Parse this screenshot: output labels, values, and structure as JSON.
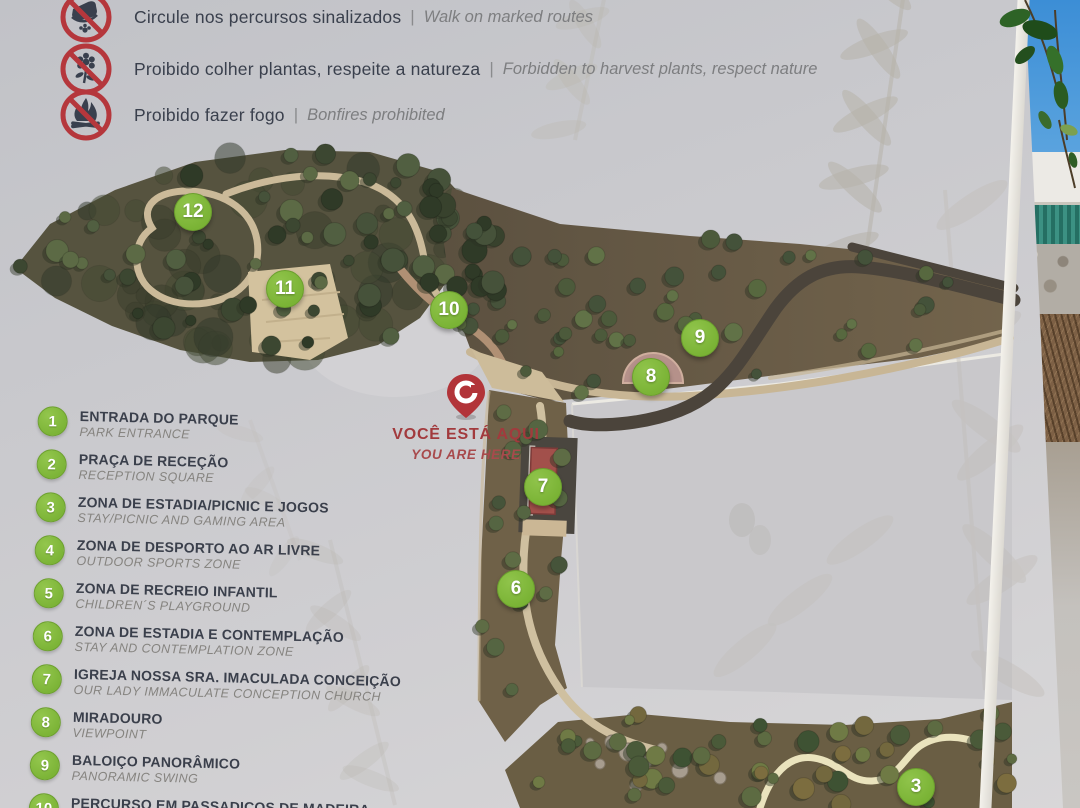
{
  "sign": {
    "rules": {
      "divider": "|",
      "items": [
        {
          "icon": "no-walking-off-trail-icon",
          "pt": "Circule nos percursos sinalizados",
          "en": "Walk on marked routes"
        },
        {
          "icon": "no-picking-plants-icon",
          "pt": "Proibido colher plantas, respeite a natureza",
          "en": "Forbidden to harvest plants, respect nature"
        },
        {
          "icon": "no-bonfires-icon",
          "pt": "Proibido fazer fogo",
          "en": "Bonfires prohibited"
        }
      ]
    },
    "you_are_here": {
      "pt": "VOCÊ ESTÁ AQUI",
      "en": "YOU ARE HERE"
    },
    "legend": {
      "items": [
        {
          "num": "1",
          "pt": "ENTRADA DO PARQUE",
          "en": "PARK ENTRANCE"
        },
        {
          "num": "2",
          "pt": "PRAÇA DE RECEÇÃO",
          "en": "RECEPTION SQUARE"
        },
        {
          "num": "3",
          "pt": "ZONA DE ESTADIA/PICNIC E JOGOS",
          "en": "STAY/PICNIC AND GAMING AREA"
        },
        {
          "num": "4",
          "pt": "ZONA DE DESPORTO AO AR LIVRE",
          "en": "OUTDOOR SPORTS ZONE"
        },
        {
          "num": "5",
          "pt": "ZONA DE RECREIO INFANTIL",
          "en": "CHILDREN´S PLAYGROUND"
        },
        {
          "num": "6",
          "pt": "ZONA DE ESTADIA E CONTEMPLAÇÃO",
          "en": "STAY AND CONTEMPLATION ZONE"
        },
        {
          "num": "7",
          "pt": "IGREJA NOSSA SRA. IMACULADA CONCEIÇÃO",
          "en": "OUR LADY IMMACULATE CONCEPTION CHURCH"
        },
        {
          "num": "8",
          "pt": "MIRADOURO",
          "en": "VIEWPOINT"
        },
        {
          "num": "9",
          "pt": "BALOIÇO PANORÂMICO",
          "en": "PANORAMIC SWING"
        },
        {
          "num": "10",
          "pt": "PERCURSO EM PASSADIÇOS DE MADEIRA",
          "en": "ROUTE ON WOODEN WALKWAYS"
        }
      ]
    },
    "map_markers": [
      {
        "num": "12",
        "x": 193,
        "y": 212
      },
      {
        "num": "11",
        "x": 285,
        "y": 289
      },
      {
        "num": "10",
        "x": 449,
        "y": 310
      },
      {
        "num": "9",
        "x": 700,
        "y": 338
      },
      {
        "num": "8",
        "x": 651,
        "y": 377
      },
      {
        "num": "7",
        "x": 543,
        "y": 487
      },
      {
        "num": "6",
        "x": 516,
        "y": 589
      },
      {
        "num": "3",
        "x": 916,
        "y": 787
      }
    ],
    "colors": {
      "accent_green": "#82b83e",
      "prohibition_red": "#b5373c",
      "here_red": "#ad393c"
    }
  }
}
